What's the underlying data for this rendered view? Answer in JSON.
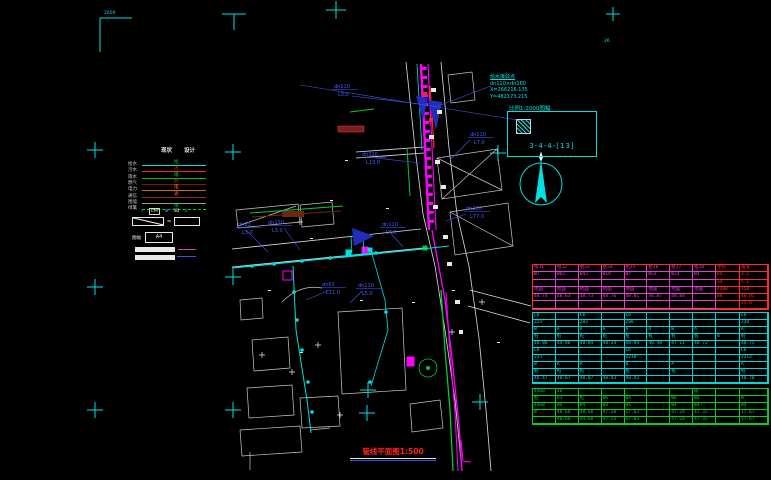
{
  "drawing": {
    "title": "管线平面图1:500",
    "corner_text_tl": "2600",
    "corner_text_tr": "26"
  },
  "connection_note": {
    "line1": "给水接驳点",
    "line2": "dn110×dn160",
    "line3": "X=266216.135",
    "line4": "Y=482173.215"
  },
  "sheet_box": {
    "caption": "比例1:2000图幅",
    "code": "3-4-4-[13]"
  },
  "legend": {
    "headers": [
      "现状",
      "设计"
    ],
    "rows": [
      {
        "label": "给水",
        "tag": "给",
        "color": "#00dede",
        "tagColor": "#00cc33",
        "dashed": false
      },
      {
        "label": "污水",
        "tag": "污",
        "color": "#ff2222",
        "tagColor": "#ff4444",
        "dashed": false
      },
      {
        "label": "雨水",
        "tag": "雨",
        "color": "#00bb22",
        "tagColor": "#00dd44",
        "dashed": false
      },
      {
        "label": "燃气",
        "tag": "燃",
        "color": "#8a1010",
        "tagColor": "#cc3333",
        "dashed": false
      },
      {
        "label": "电力",
        "tag": "电",
        "color": "#cc6a1a",
        "tagColor": "#ff8833",
        "dashed": false
      },
      {
        "label": "通信",
        "tag": "通",
        "color": "#8a3030",
        "tagColor": "#cc6666",
        "dashed": false
      },
      {
        "label": "围墙",
        "tag": "",
        "color": "#9a9a9a",
        "tagColor": "",
        "dashed": false
      },
      {
        "label": "绿篱",
        "tag": "绿",
        "color": "#00cc33",
        "tagColor": "#00dd44",
        "dashed": true
      }
    ],
    "symbols": [
      {
        "t": "≈",
        "c": "#3355ff",
        "box": false
      },
      {
        "t": "CM",
        "c": "#eeeeee",
        "box": true
      },
      {
        "t": "◆",
        "c": "#3355ff",
        "box": false
      },
      {
        "t": "3B",
        "c": "#eeeeee",
        "box": false
      },
      {
        "t": "∠",
        "c": "#00cc33",
        "box": false
      }
    ],
    "slope_eq": "=",
    "scale_label": "图幅",
    "scale_value": "A4"
  },
  "map_labels": [
    {
      "x": 334,
      "y": 88,
      "size": "dn110",
      "len": "L3.0"
    },
    {
      "x": 362,
      "y": 156,
      "size": "dn110",
      "len": "L13.0"
    },
    {
      "x": 238,
      "y": 226,
      "size": "dn63",
      "len": "L3.0"
    },
    {
      "x": 268,
      "y": 224,
      "size": "dn110",
      "len": "L3.0"
    },
    {
      "x": 382,
      "y": 226,
      "size": "dn110",
      "len": "L4.0"
    },
    {
      "x": 322,
      "y": 286,
      "size": "dn63",
      "len": "L11.0"
    },
    {
      "x": 358,
      "y": 287,
      "size": "dn110",
      "len": "L5.0"
    },
    {
      "x": 470,
      "y": 136,
      "size": "dn110",
      "len": "L7.0"
    },
    {
      "x": 466,
      "y": 210,
      "size": "dn110",
      "len": "L77.0"
    }
  ],
  "table": {
    "sections": [
      {
        "color": "#e040cc",
        "accent": "#ff2a2a",
        "red_cols": [
          8,
          9
        ],
        "row_h": 6.3,
        "rows": [
          [
            "给J1",
            "给J2",
            "给J3",
            "给J4",
            "给J5",
            "给J6",
            "给J7",
            "给J8",
            "坐标",
            "角度"
          ],
          [
            "W7",
            "W65",
            "W42",
            "W19",
            "W7",
            "W53",
            "W24",
            "W4",
            "84",
            "3.1"
          ],
          [
            "",
            "",
            "",
            "",
            "",
            "",
            "",
            "",
            "34",
            "5.1"
          ],
          [
            "地面",
            "地面",
            "地面",
            "地面",
            "地面",
            "地面",
            "地面",
            "地面",
            "4488",
            "158"
          ],
          [
            "48.74",
            "48.63",
            "48.73",
            "48.76",
            "48.81",
            "44.87",
            "48.84",
            "",
            "88",
            "48.05"
          ],
          [
            "",
            "",
            "",
            "",
            "",
            "",
            "",
            "",
            "",
            "15.8"
          ]
        ]
      },
      {
        "color": "#00d8d8",
        "accent": "#00d8d8",
        "red_cols": [],
        "row_h": 6,
        "rows": [
          [
            "Lb",
            "",
            "Lb",
            "",
            "Lb",
            "",
            "",
            "",
            "",
            "Lb"
          ],
          [
            "225",
            "",
            "283",
            "",
            "288",
            "",
            "",
            "",
            "",
            "220"
          ],
          [
            "W",
            "A",
            "A",
            "A",
            "A",
            "A",
            "W",
            "A",
            "",
            "A"
          ],
          [
            "桩",
            "桩",
            "桩",
            "桩",
            "桩",
            "桩",
            "桩",
            "桩",
            "m",
            "桩"
          ],
          [
            "48.86",
            "44.86",
            "48.84",
            "48.34",
            "48.94",
            "48.48",
            "47.11",
            "48.72",
            "",
            "48.75"
          ],
          [
            "Lb",
            "",
            "",
            "",
            "Lb",
            "",
            "",
            "",
            "",
            "Lb"
          ],
          [
            "225",
            "",
            "",
            "",
            "2210",
            "",
            "",
            "",
            "",
            "2212"
          ],
          [
            "W",
            "A",
            "A",
            "",
            "W",
            "",
            "A",
            "",
            "",
            "A"
          ],
          [
            "桩",
            "桩",
            "桩",
            "",
            "桩",
            "",
            "桩",
            "",
            "",
            "桩"
          ],
          [
            "48.47",
            "48.67",
            "48.07",
            "48.43",
            "48.43",
            "",
            "",
            "",
            "",
            "48.78"
          ]
        ]
      },
      {
        "color": "#00cc33",
        "accent": "#00cc33",
        "red_cols": [],
        "row_h": 6,
        "rows": [
          [
            "4468",
            "48",
            "",
            "",
            "",
            "",
            "",
            "碰",
            "",
            ""
          ],
          [
            "桩",
            "D3",
            "桩",
            "W6",
            "W4",
            "",
            "W6",
            "W4",
            "",
            "W"
          ],
          [
            "4468",
            "W4",
            "W4",
            "W4",
            "W4",
            "",
            "W4",
            "W47",
            "",
            "W4"
          ],
          [
            "W",
            "48.66",
            "48.68",
            "47.38",
            "17.63",
            "",
            "47.24",
            "47.32",
            "",
            "17.67"
          ],
          [
            "",
            "46.66",
            "44.68",
            "47.24",
            "17.63",
            "",
            "47.24",
            "47.32",
            "",
            "17.67"
          ]
        ]
      }
    ]
  }
}
